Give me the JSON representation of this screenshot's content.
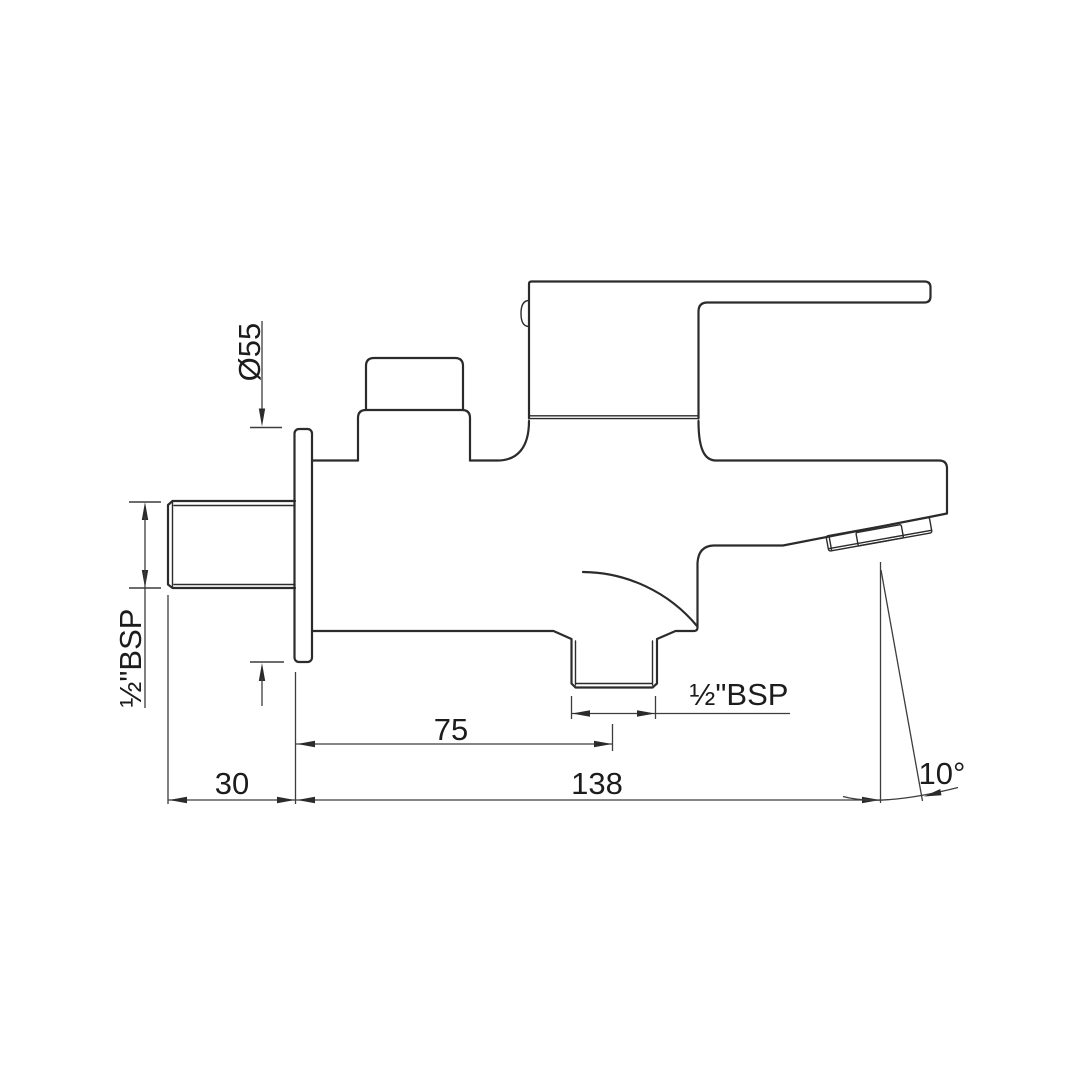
{
  "drawing": {
    "kind": "technical dimension drawing",
    "subject": "wall-mounted single-lever bath spout, side elevation",
    "background_color": "#ffffff",
    "line_color": "#2b2b2b",
    "dimension_color": "#3d3d3d"
  },
  "labels": {
    "flange_diameter": "Ø55",
    "inlet_thread": "½\"BSP",
    "wall_projection": "30",
    "outlet_offset": "75",
    "spout_reach": "138",
    "outlet_thread": "½\"BSP",
    "spout_angle": "10°"
  }
}
